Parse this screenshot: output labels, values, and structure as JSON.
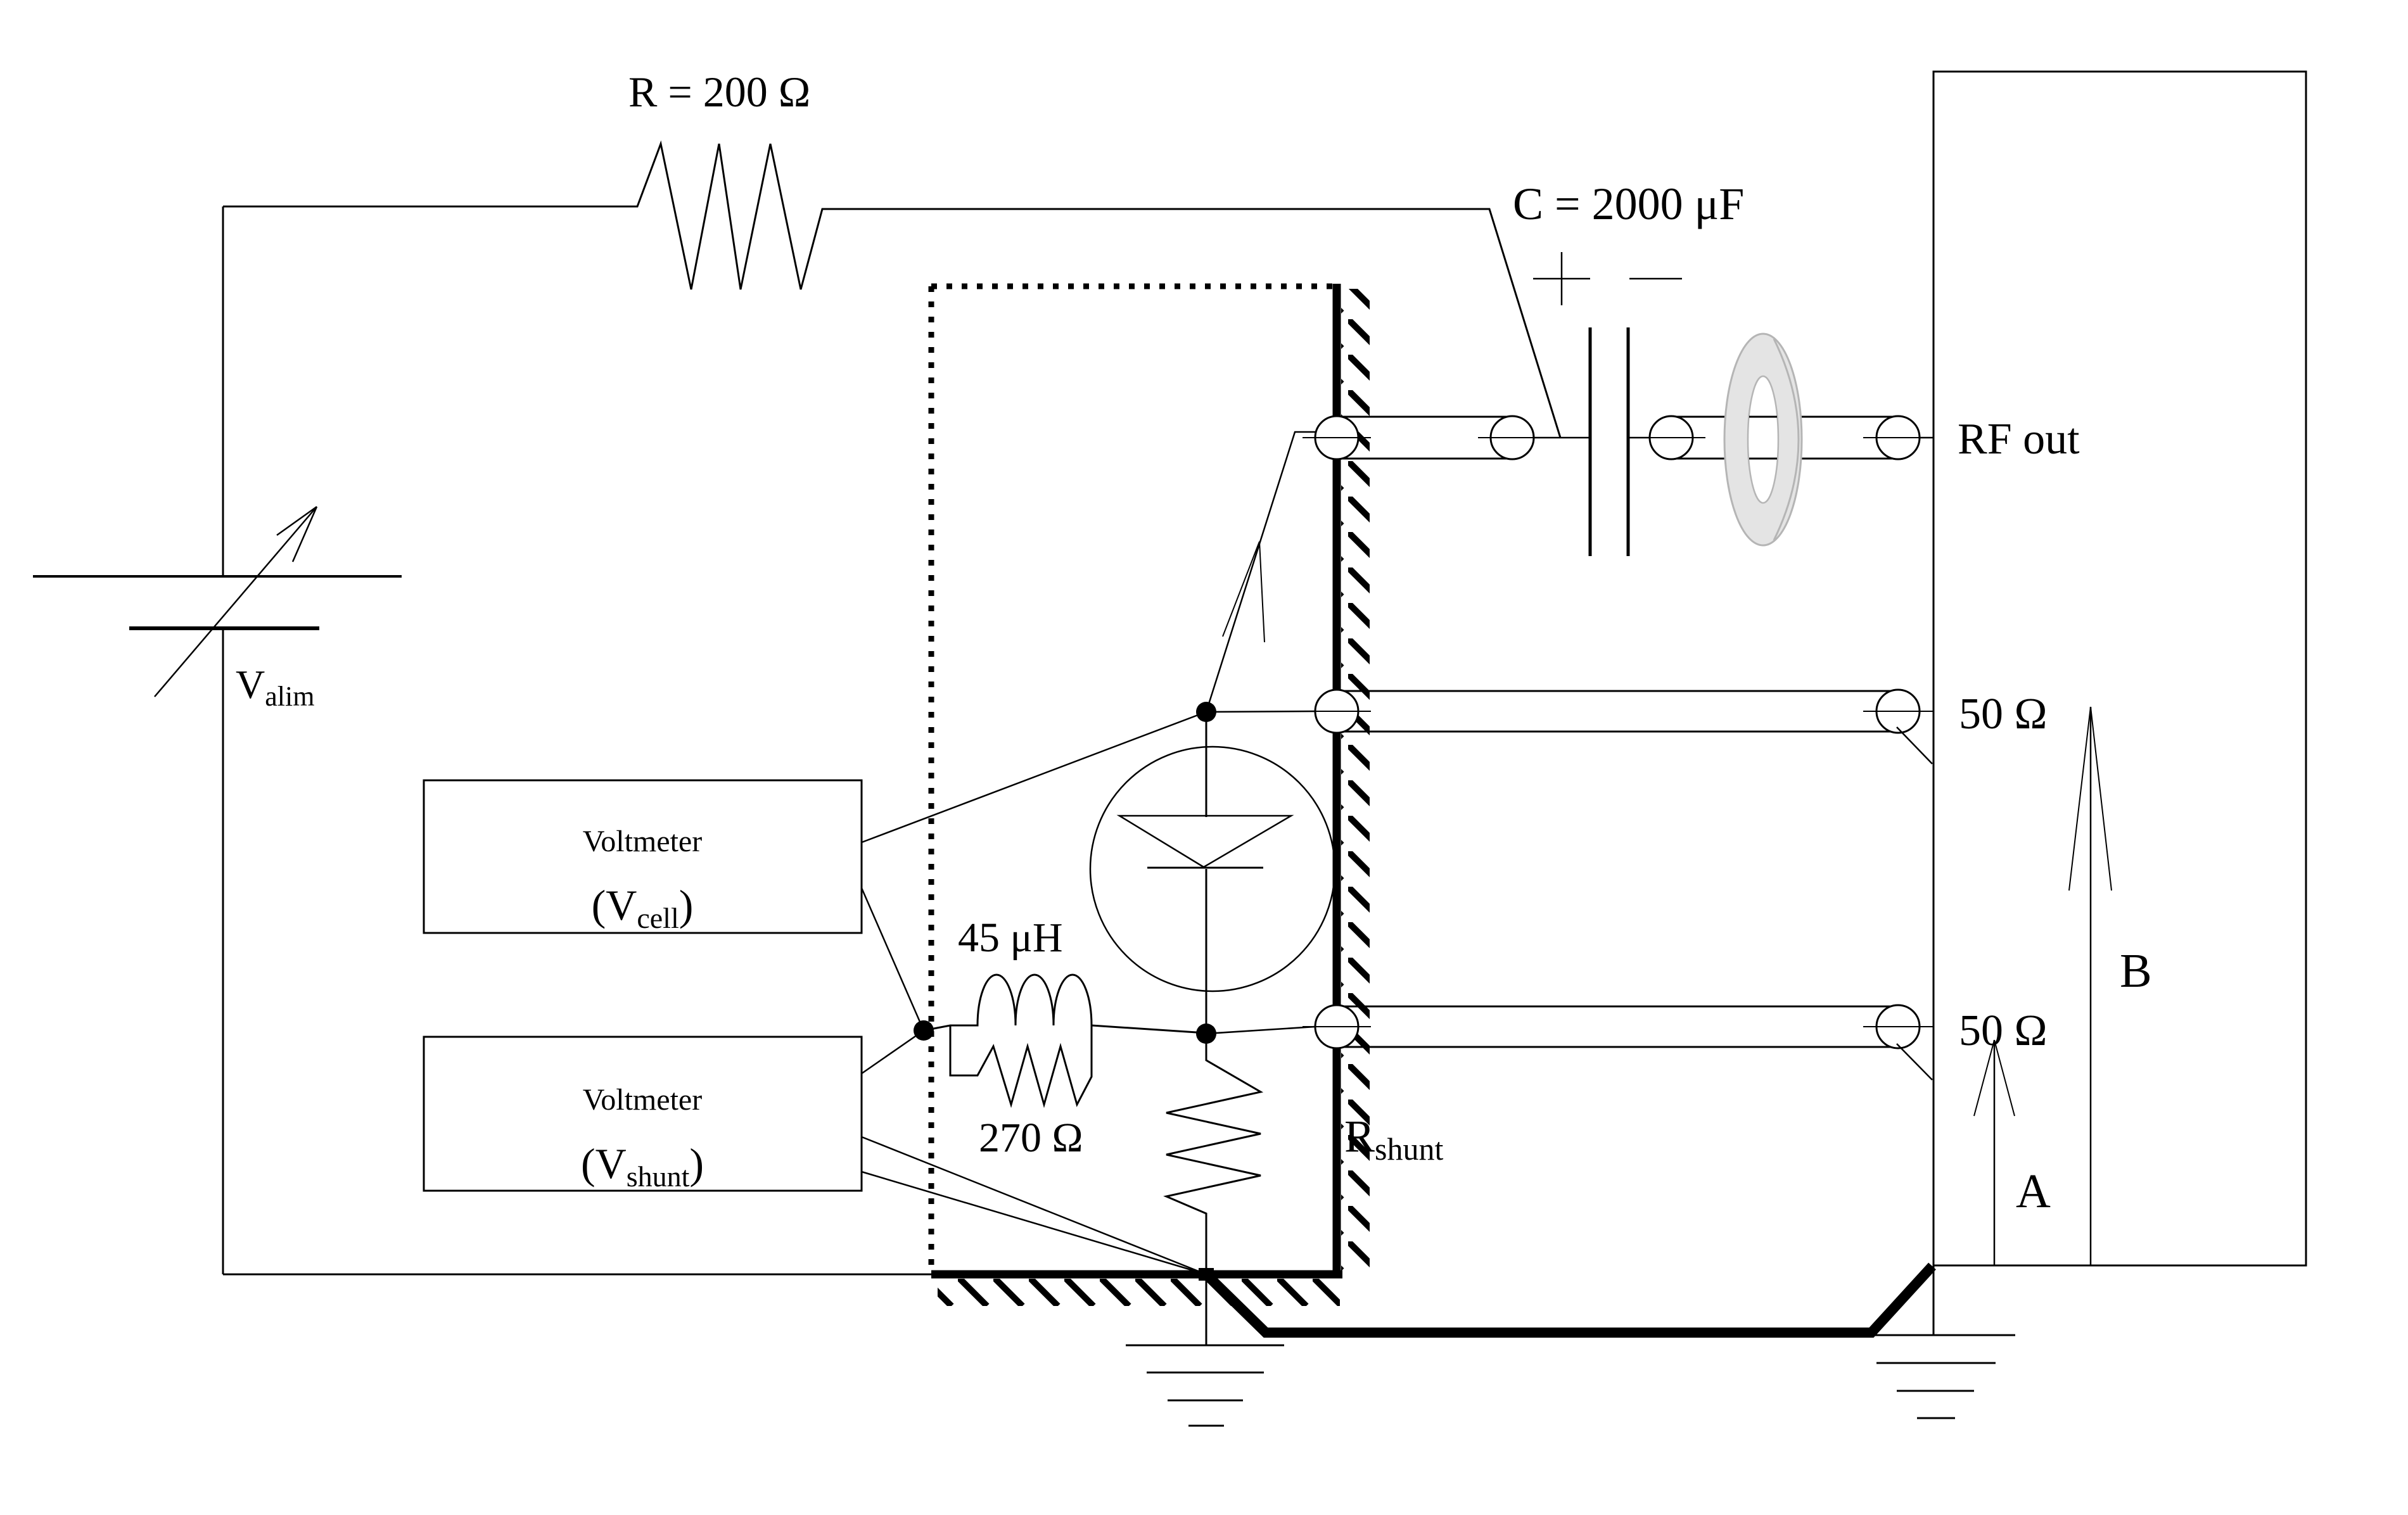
{
  "colors": {
    "ink": "#000000",
    "background": "#ffffff",
    "toroid_fill": "#e4e4e4",
    "toroid_edge": "#b5b5b5"
  },
  "labels": {
    "series_resistor": "R = 200 Ω",
    "blocking_capacitor": "C = 2000 μF",
    "cap_plus": "+",
    "rf_out": "RF out",
    "load_upper": "50 Ω",
    "load_lower": "50 Ω",
    "probe_a": "A",
    "probe_b": "B",
    "supply": {
      "main": "V",
      "sub": "alim"
    },
    "voltmeter_cell": {
      "title": "Voltmeter",
      "open": "(V",
      "sub": "cell",
      "close": ")"
    },
    "voltmeter_shunt": {
      "title": "Voltmeter",
      "open": "(V",
      "sub": "shunt",
      "close": ")"
    },
    "inductor": "45 μH",
    "parallel_resistor": "270 Ω",
    "shunt_resistor": {
      "main": "R",
      "sub": "shunt"
    }
  }
}
